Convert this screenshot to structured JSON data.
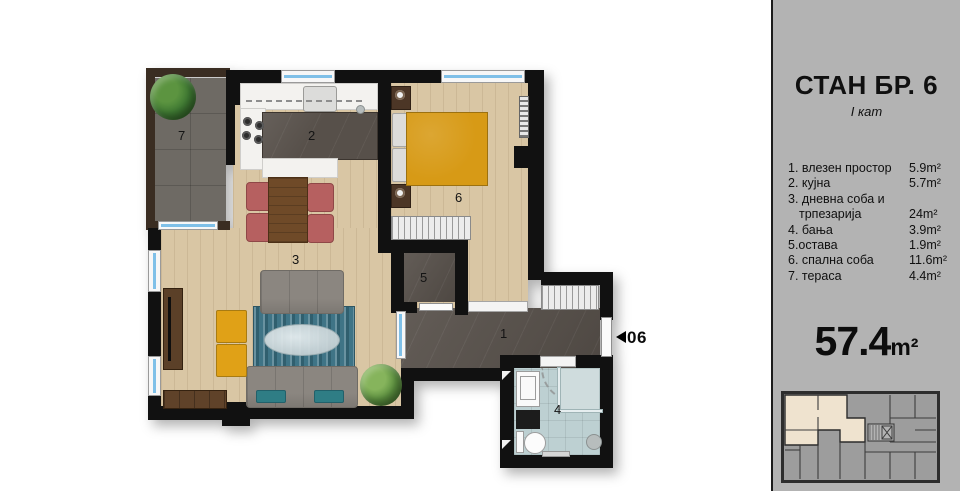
{
  "panel": {
    "title": "СТАН БР. 6",
    "subtitle": "I кат",
    "legend": {
      "rows": [
        {
          "label": "1. влезен простор",
          "area": "5.9m²"
        },
        {
          "label": "2. кујна",
          "area": "5.7m²"
        },
        {
          "label": "3. дневна соба и",
          "area": ""
        },
        {
          "label": "трпезарија",
          "area": "24m²"
        },
        {
          "label": "4. бања",
          "area": "3.9m²"
        },
        {
          "label": "5.остава",
          "area": "1.9m²"
        },
        {
          "label": "6. спална соба",
          "area": "11.6m²"
        },
        {
          "label": "7. тераса",
          "area": "4.4m²"
        }
      ]
    },
    "total_value": "57.4",
    "total_unit": "m²"
  },
  "plan": {
    "room_labels": {
      "entry": "1",
      "kitchen": "2",
      "living": "3",
      "bath": "4",
      "storage": "5",
      "bedroom": "6",
      "terrace": "7"
    },
    "entry_door_label": "06"
  },
  "colors": {
    "wall": "#111111",
    "wood": "#d9c6a4",
    "tile-dark": "#57504a",
    "tile-terrace": "#6e6a64",
    "tile-bath": "#bdd0d2",
    "window": "#7fc0e8",
    "bed": "#d79a16",
    "ottoman": "#e0a117",
    "sofa": "#8b8680",
    "rug": "#3f7486",
    "chair": "#b66060",
    "panel": "#b3b3b3",
    "unit-highlight": "#efe3cf"
  }
}
